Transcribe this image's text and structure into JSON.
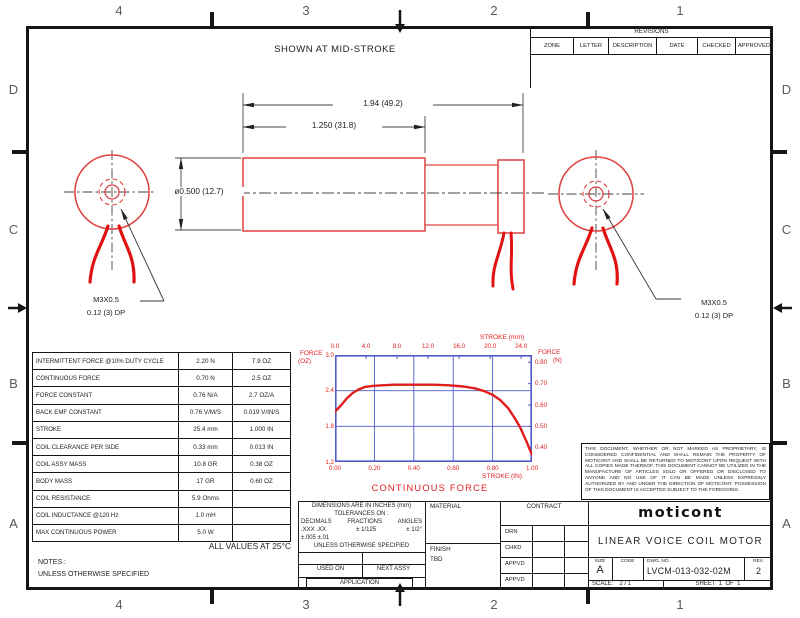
{
  "zones": {
    "top": [
      "4",
      "3",
      "2",
      "1"
    ],
    "bottom": [
      "4",
      "3",
      "2",
      "1"
    ],
    "left": [
      "D",
      "C",
      "B",
      "A"
    ],
    "right": [
      "D",
      "C",
      "B",
      "A"
    ]
  },
  "revisions": {
    "title": "REVISIONS",
    "columns": [
      "ZONE",
      "LETTER",
      "DESCRIPTION",
      "DATE",
      "CHECKED",
      "APPROVED"
    ]
  },
  "drawing": {
    "caption": "SHOWN AT MID-STROKE",
    "dim_overall": "1.94 (49.2)",
    "dim_body": "1.250 (31.8)",
    "dim_diameter": "ø0.500 (12.7)",
    "thread_note": {
      "line1": "M3X0.5",
      "line2": "0.12 (3) DP"
    }
  },
  "specs": {
    "rows": [
      {
        "label": "INTERMITTENT FORCE @10% DUTY CYCLE",
        "metric": "2.20 N",
        "imperial": "7.9 OZ"
      },
      {
        "label": "CONTINUOUS FORCE",
        "metric": "0.70 N",
        "imperial": "2.5 OZ"
      },
      {
        "label": "FORCE CONSTANT",
        "metric": "0.76 N/A",
        "imperial": "2.7 OZ/A"
      },
      {
        "label": "BACK EMF CONSTANT",
        "metric": "0.76 V/M/S",
        "imperial": "0.019 V/IN/S"
      },
      {
        "label": "STROKE",
        "metric": "25.4 mm",
        "imperial": "1.000 IN"
      },
      {
        "label": "COIL CLEARANCE PER SIDE",
        "metric": "0.33 mm",
        "imperial": "0.013 IN"
      },
      {
        "label": "COIL ASSY MASS",
        "metric": "10.8 GR",
        "imperial": "0.38 OZ"
      },
      {
        "label": "BODY MASS",
        "metric": "17 GR",
        "imperial": "0.60 OZ"
      },
      {
        "label": "COIL RESISTANCE",
        "metric": "5.9 Ohms",
        "imperial": ""
      },
      {
        "label": "COIL INDUCTANCE @120 Hz",
        "metric": "1.0 mH",
        "imperial": ""
      },
      {
        "label": "MAX CONTINUOUS POWER",
        "metric": "5.0 W",
        "imperial": ""
      }
    ],
    "footnote": "ALL VALUES AT 25°C",
    "notes_label": "NOTES :",
    "notes_line": "UNLESS OTHERWISE SPECIFIED"
  },
  "chart_data": {
    "type": "line",
    "title": "CONTINUOUS FORCE",
    "top_axis": {
      "label": "STROKE (mm)",
      "values": [
        0,
        4,
        8,
        12,
        16,
        20,
        24
      ],
      "labels": [
        "0.0",
        "4.0",
        "8.0",
        "12.0",
        "16.0",
        "20.0",
        "24.0"
      ],
      "max": 25.4
    },
    "bottom_axis": {
      "label": "STROKE (IN)",
      "values": [
        0,
        0.2,
        0.4,
        0.6,
        0.8,
        1.0
      ],
      "labels": [
        "0.00",
        "0.20",
        "0.40",
        "0.60",
        "0.80",
        "1.00"
      ],
      "range": [
        0,
        1
      ]
    },
    "left_axis": {
      "label_line1": "FORCE",
      "label_line2": "(OZ)",
      "values": [
        3.0,
        2.4,
        1.8,
        1.2
      ],
      "labels": [
        "3.0",
        "2.4",
        "1.8",
        "1.2"
      ],
      "range": [
        1.2,
        3.0
      ]
    },
    "right_axis": {
      "label_line1": "FORCE",
      "label_line2": "(N)",
      "values": [
        0.8,
        0.7,
        0.6,
        0.5,
        0.4
      ],
      "labels": [
        "0.80",
        "0.70",
        "0.60",
        "0.50",
        "0.40"
      ]
    },
    "grid": true,
    "colors": {
      "grid": "#4d5bc9",
      "curve": "#e01d1d",
      "text": "#e02020"
    },
    "series": [
      {
        "name": "continuous force",
        "x": [
          0.0,
          0.03,
          0.06,
          0.09,
          0.12,
          0.15,
          0.19,
          0.24,
          0.3,
          0.4,
          0.5,
          0.58,
          0.65,
          0.71,
          0.76,
          0.8,
          0.84,
          0.88,
          0.91,
          0.94,
          0.97,
          1.0
        ],
        "y_oz": [
          2.05,
          2.15,
          2.27,
          2.36,
          2.42,
          2.46,
          2.48,
          2.49,
          2.5,
          2.5,
          2.5,
          2.49,
          2.47,
          2.44,
          2.39,
          2.33,
          2.24,
          2.1,
          1.95,
          1.78,
          1.56,
          1.32
        ]
      }
    ]
  },
  "tolerance": {
    "line1": "DIMENSIONS ARE IN INCHES (mm)",
    "line2": "TOLERANCES ON :",
    "dec_h": "DECIMALS",
    "frac_h": "FRACTIONS",
    "ang_h": "ANGLES",
    "dec_v": ".XXX  .XX",
    "frac_v": "±  1/125",
    "ang_v": "± 1/2°",
    "dec_v2": "±.005 ±.01",
    "line_unless": "UNLESS OTHERWISE SPECIFIED",
    "used_on": "USED ON",
    "next_assy": "NEXT ASSY",
    "application": "APPLICATION"
  },
  "material": {
    "label": "MATERIAL",
    "finish_label": "FINISH",
    "finish_value": "TBD"
  },
  "contract": {
    "label": "CONTRACT",
    "rows": [
      "DRN",
      "CHKD",
      "APPVD",
      "APPVD"
    ]
  },
  "disclaimer": {
    "text": "THIS DOCUMENT, WHETHER OR NOT MARKED AS PROPRIETARY, IS CONSIDERED CONFIDENTIAL AND SHALL REMAIN THE PROPERTY OF MOTICONT AND SHALL BE RETURNED TO MOTICONT UPON REQUEST WITH ALL COPIES MADE THEREOF. THIS DOCUMENT CANNOT BE UTILIZED IN THE MANUFACTURE OF ARTICLES SOLD OR OFFERED OR DISCLOSED TO ANYONE AND NO USE OF IT CAN BE MADE UNLESS EXPRESSLY AUTHORIZED BY AND UNDER THE DIRECTION OF MOTICONT. POSSESSION OF THIS DOCUMENT IS ACCEPTED SUBJECT TO THE FOREGOING."
  },
  "titleblock": {
    "logo": "moticont",
    "title": "LINEAR VOICE COIL MOTOR",
    "size_label": "SIZE",
    "size": "A",
    "code_label": "CODE",
    "dwg_label": "DWG. NO.",
    "dwg_no": "LVCM-013-032-02M",
    "rev_label": "REV.",
    "rev": "2",
    "scale_label": "SCALE:",
    "scale_value": "2 / 1",
    "sheet": "SHEET  1  OF  1"
  }
}
